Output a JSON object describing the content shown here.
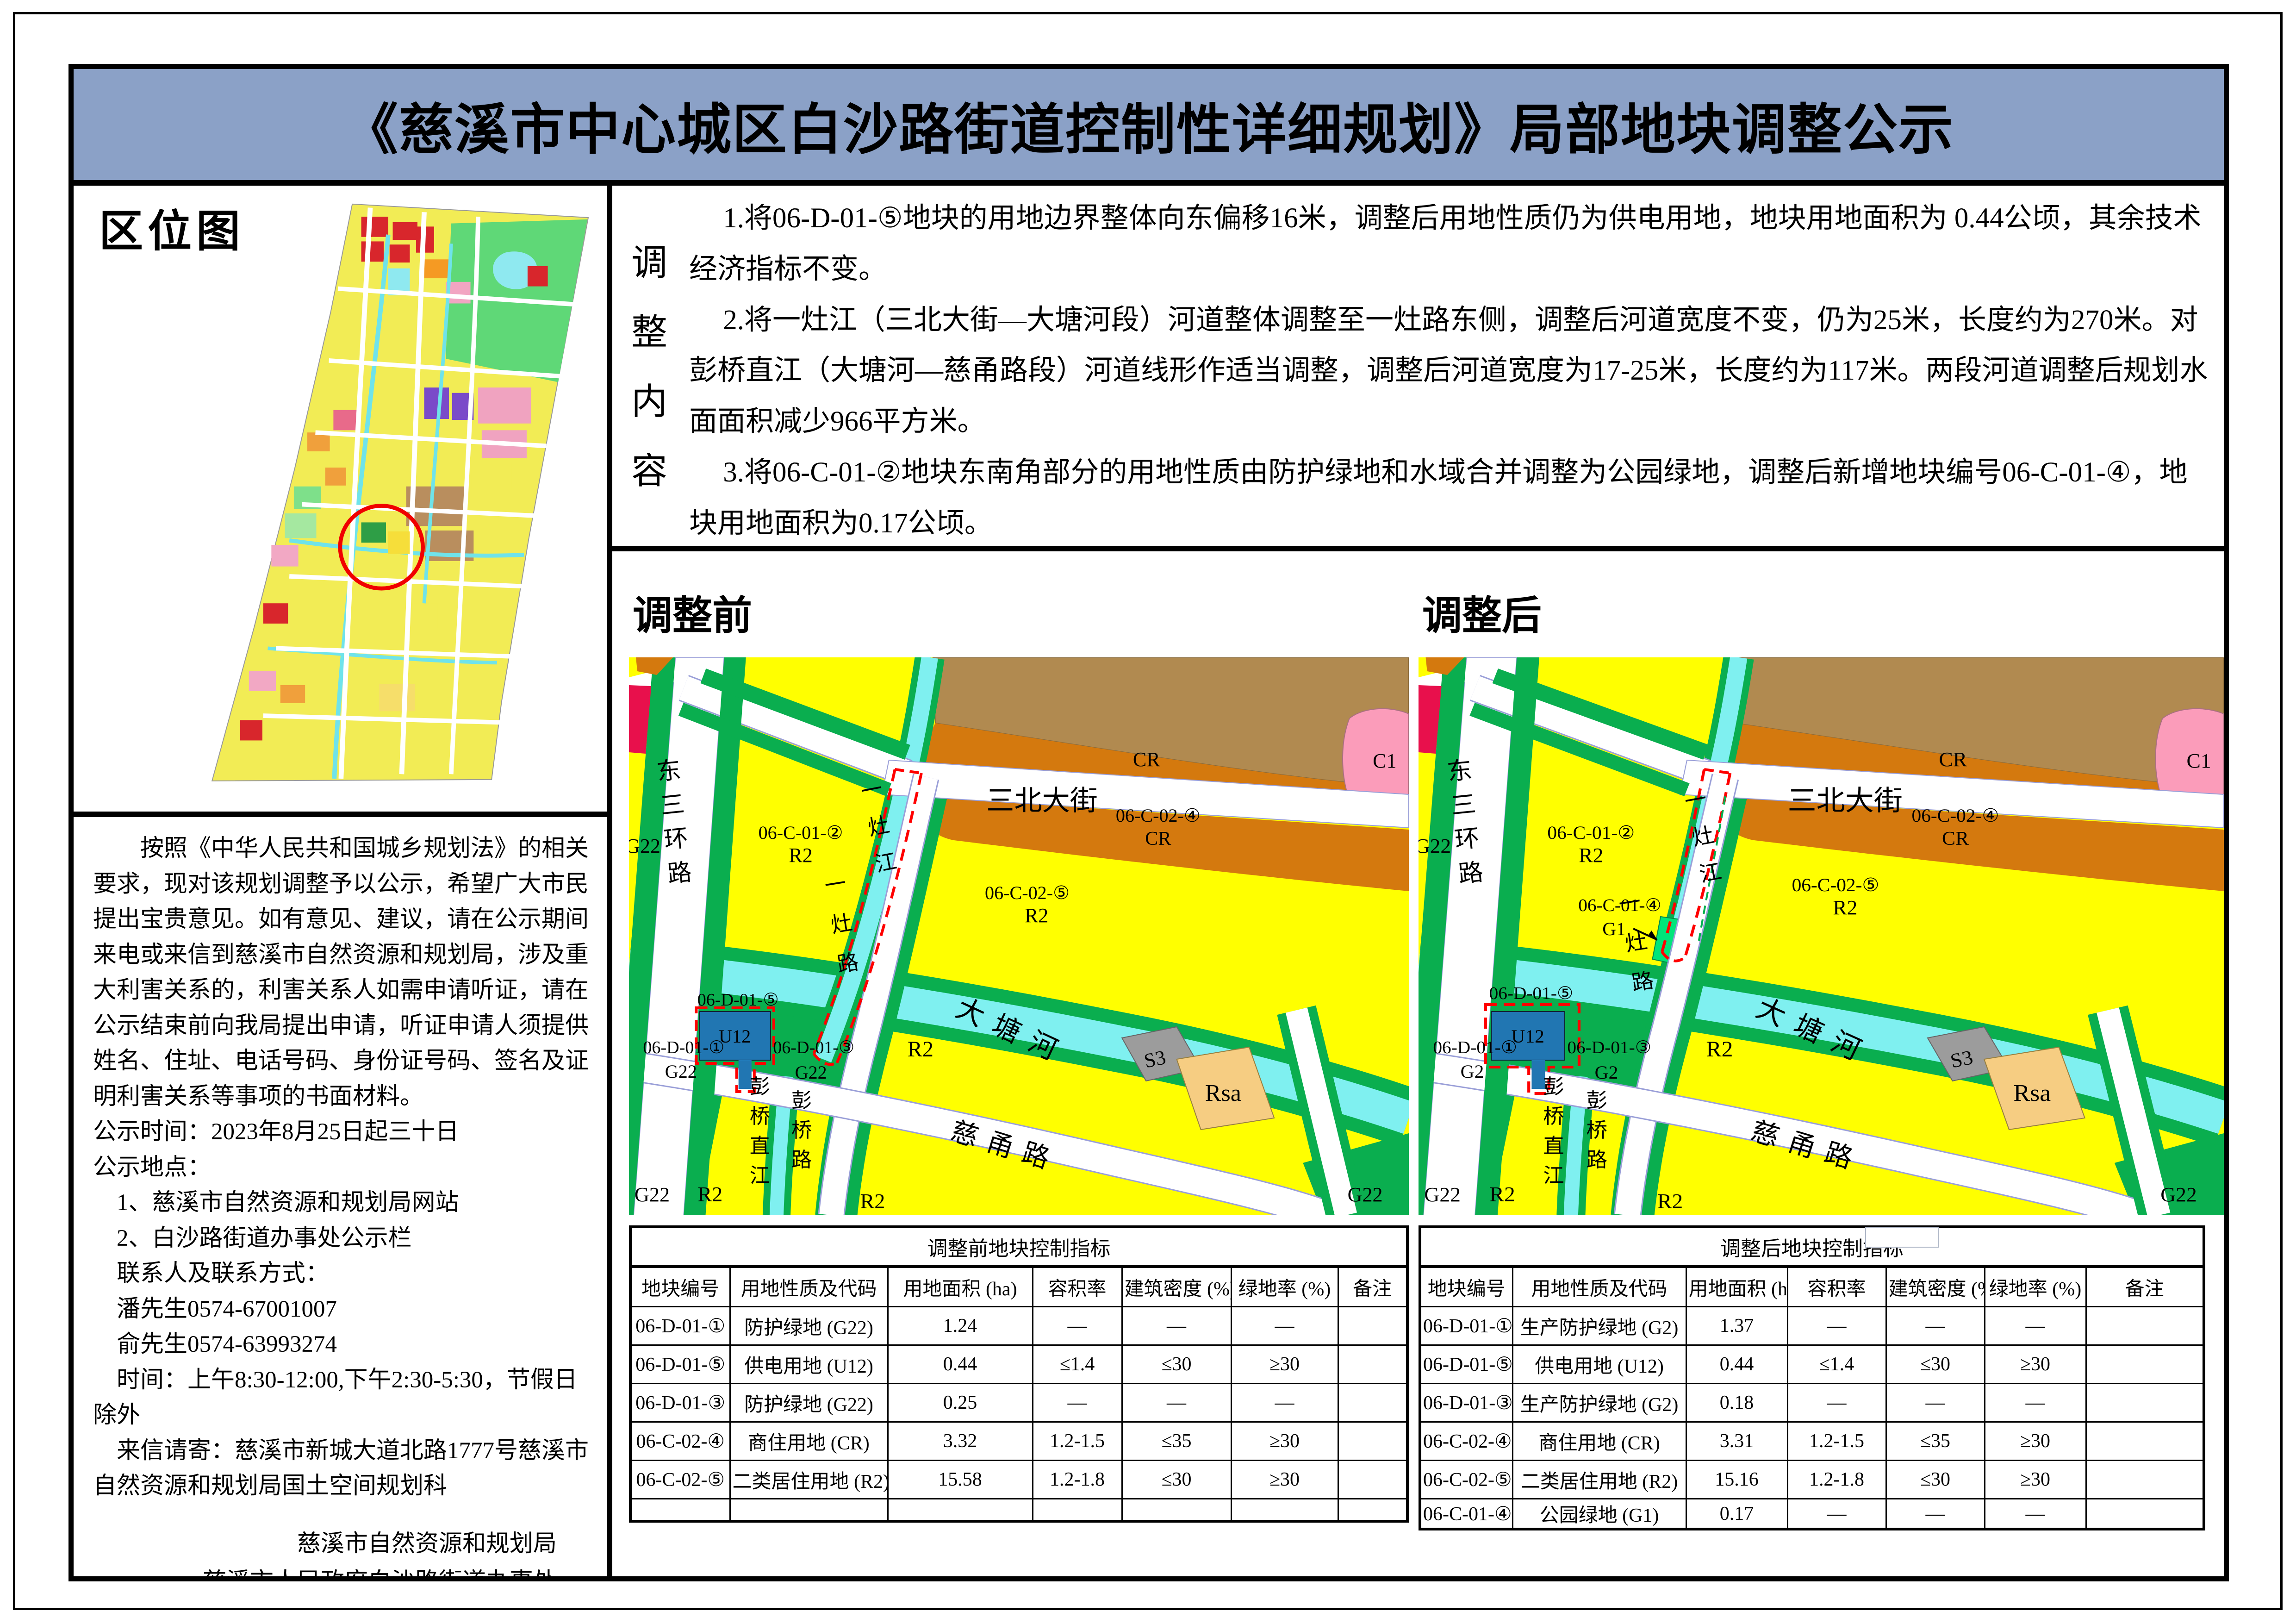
{
  "page_title": "《慈溪市中心城区白沙路街道控制性详细规划》局部地块调整公示",
  "location_map": {
    "label": "区位图"
  },
  "notice": {
    "paragraph": "按照《中华人民共和国城乡规划法》的相关要求，现对该规划调整予以公示，希望广大市民提出宝贵意见。如有意见、建议，请在公示期间来电或来信到慈溪市自然资源和规划局，涉及重大利害关系的，利害关系人如需申请听证，请在公示结束前向我局提出申请，听证申请人须提供姓名、住址、电话号码、身份证号码、签名及证明利害关系等事项的书面材料。",
    "lines": [
      "公示时间：2023年8月25日起三十日",
      "公示地点：",
      "　1、慈溪市自然资源和规划局网站",
      "　2、白沙路街道办事处公示栏",
      "　联系人及联系方式：",
      "　潘先生0574-67001007",
      "　俞先生0574-63993274",
      "　时间：上午8:30-12:00,下午2:30-5:30，节假日除外",
      "　来信请寄：慈溪市新城大道北路1777号慈溪市自然资源和规划局国土空间规划科"
    ],
    "signatures": [
      "慈溪市自然资源和规划局",
      "慈溪市人民政府白沙路街道办事处",
      "二〇二三年八月二十五日"
    ]
  },
  "adjustment": {
    "label_chars": [
      "调",
      "整",
      "内",
      "容"
    ],
    "paragraphs": [
      "1.将06-D-01-⑤地块的用地边界整体向东偏移16米，调整后用地性质仍为供电用地，地块用地面积为 0.44公顷，其余技术经济指标不变。",
      "2.将一灶江（三北大街—大塘河段）河道整体调整至一灶路东侧，调整后河道宽度不变，仍为25米，长度约为270米。对彭桥直江（大塘河—慈甬路段）河道线形作适当调整，调整后河道宽度为17-25米，长度约为117米。两段河道调整后规划水面面积减少966平方米。",
      "3.将06-C-01-②地块东南角部分的用地性质由防护绿地和水域合并调整为公园绿地，调整后新增地块编号06-C-01-④，地块用地面积为0.17公顷。"
    ]
  },
  "maps": {
    "before": {
      "title": "调整前",
      "parcels": {
        "d5": "06-D-01-⑤",
        "u12": "U12",
        "d1": "06-D-01-①",
        "d1_code": "G22",
        "d3": "06-D-01-③",
        "d3_code": "G22"
      }
    },
    "after": {
      "title": "调整后",
      "parcels": {
        "d5": "06-D-01-⑤",
        "u12": "U12",
        "d1": "06-D-01-①",
        "d1_code": "G2",
        "d3": "06-D-01-③",
        "d3_code": "G2",
        "c4": "06-C-01-④",
        "c4_code": "G1"
      }
    },
    "shared": {
      "streets": {
        "dong_san_huan": "东三环路",
        "san_bei": "三北大街",
        "yi_zao_jiang": "一灶江",
        "yi_zao_lu": "一灶路",
        "da_tang_he": "大塘河",
        "ci_yong_lu": "慈甬路",
        "peng_qiao_zhi_jiang": "彭桥直江",
        "peng_qiao_lu": "彭桥路"
      },
      "zones": {
        "g22": "G22",
        "r2": "R2",
        "cr": "CR",
        "c1": "C1",
        "c2_4": "06-C-02-④",
        "c2_5": "06-C-02-⑤",
        "c1_2": "06-C-01-②",
        "s3": "S3",
        "rsa": "Rsa"
      }
    }
  },
  "tables": {
    "before": {
      "title": "调整前地块控制指标",
      "headers": [
        "地块编号",
        "用地性质及代码",
        "用地面积 (ha)",
        "容积率",
        "建筑密度 (%)",
        "绿地率 (%)",
        "备注"
      ],
      "rows": [
        [
          "06-D-01-①",
          "防护绿地 (G22)",
          "1.24",
          "—",
          "—",
          "—",
          ""
        ],
        [
          "06-D-01-⑤",
          "供电用地 (U12)",
          "0.44",
          "≤1.4",
          "≤30",
          "≥30",
          ""
        ],
        [
          "06-D-01-③",
          "防护绿地 (G22)",
          "0.25",
          "—",
          "—",
          "—",
          ""
        ],
        [
          "06-C-02-④",
          "商住用地 (CR)",
          "3.32",
          "1.2-1.5",
          "≤35",
          "≥30",
          ""
        ],
        [
          "06-C-02-⑤",
          "二类居住用地 (R2)",
          "15.58",
          "1.2-1.8",
          "≤30",
          "≥30",
          ""
        ],
        [
          "",
          "",
          "",
          "",
          "",
          "",
          ""
        ]
      ]
    },
    "after": {
      "title": "调整后地块控制指标",
      "headers": [
        "地块编号",
        "用地性质及代码",
        "用地面积 (ha)",
        "容积率",
        "建筑密度 (%)",
        "绿地率 (%)",
        "备注"
      ],
      "rows": [
        [
          "06-D-01-①",
          "生产防护绿地 (G2)",
          "1.37",
          "—",
          "—",
          "—",
          ""
        ],
        [
          "06-D-01-⑤",
          "供电用地 (U12)",
          "0.44",
          "≤1.4",
          "≤30",
          "≥30",
          ""
        ],
        [
          "06-D-01-③",
          "生产防护绿地 (G2)",
          "0.18",
          "—",
          "—",
          "—",
          ""
        ],
        [
          "06-C-02-④",
          "商住用地 (CR)",
          "3.31",
          "1.2-1.5",
          "≤35",
          "≥30",
          ""
        ],
        [
          "06-C-02-⑤",
          "二类居住用地 (R2)",
          "15.16",
          "1.2-1.8",
          "≤30",
          "≥30",
          ""
        ],
        [
          "06-C-01-④",
          "公园绿地 (G1)",
          "0.17",
          "—",
          "—",
          "—",
          ""
        ]
      ]
    }
  },
  "colors": {
    "title_bg": "#8ba1c7",
    "boundary_red": "#ff0000",
    "zoning": {
      "r2_yellow": "#ffff00",
      "protective_green": "#0aae4f",
      "park_green": "#00e57a",
      "water_cyan": "#7ff0f0",
      "village_tan": "#b18a50",
      "cr_orange": "#d4790e",
      "c1_pink": "#fb9cba",
      "red_block": "#e8104c",
      "s3_gray": "#9c9c9c",
      "rsa_tan": "#f6cd82",
      "u12_blue": "#2176b2"
    }
  }
}
